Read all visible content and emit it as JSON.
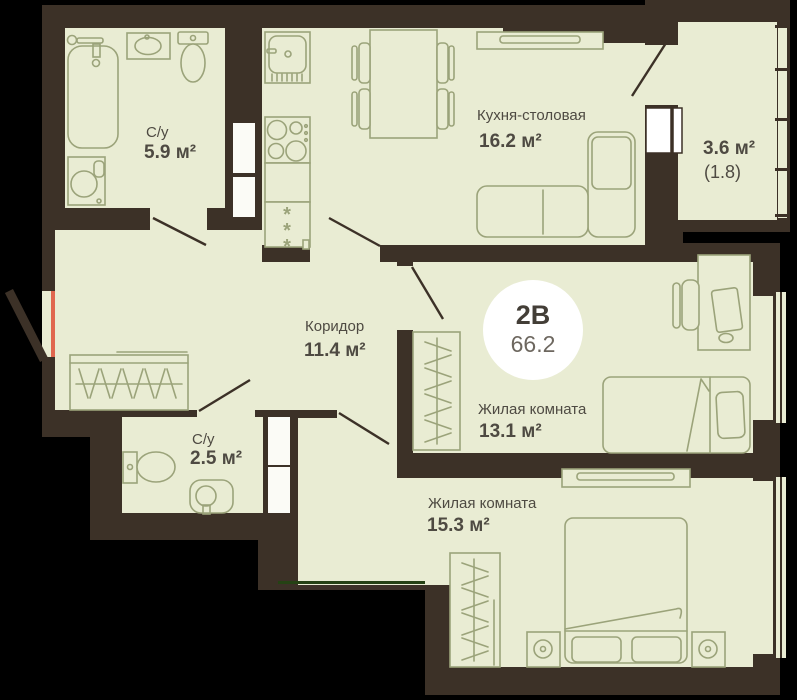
{
  "badge": {
    "type": "2В",
    "area": "66.2"
  },
  "rooms": {
    "bathroom_1": {
      "label": "С/у",
      "area": "5.9 м²"
    },
    "kitchen_dining": {
      "label": "Кухня-столовая",
      "area": "16.2 м²"
    },
    "balcony": {
      "area": "3.6 м²",
      "area_reduced": "(1.8)"
    },
    "corridor": {
      "label": "Коридор",
      "area": "11.4 м²"
    },
    "bathroom_2": {
      "label": "С/у",
      "area": "2.5 м²"
    },
    "bedroom_1": {
      "label": "Жилая комната",
      "area": "13.1 м²"
    },
    "bedroom_2": {
      "label": "Жилая комната",
      "area": "15.3 м²"
    }
  },
  "furniture": {
    "fridge_mark": "*"
  },
  "colors": {
    "background": "#000000",
    "wall": "#3c3127",
    "floor": "#e9ecd3",
    "furniture_stroke": "#9ba37a",
    "text": "#4e4a42",
    "badge_background": "#ffffff",
    "entrance_accent": "#e0674f",
    "section_line": "#254214",
    "shaft": "#fbfbf6"
  }
}
